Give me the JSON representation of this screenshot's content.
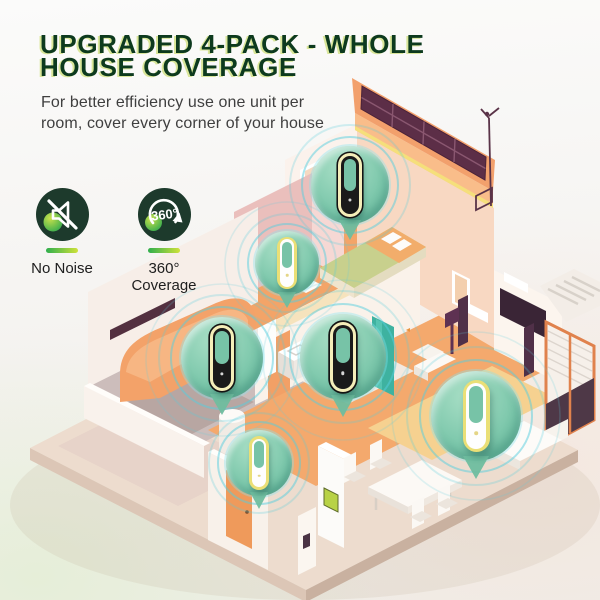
{
  "header": {
    "title_lines": [
      "UPGRADED 4-PACK - WHOLE",
      "HOUSE COVERAGE"
    ],
    "subtitle_lines": [
      "For better efficiency use one unit per",
      "room, cover every corner of your house"
    ]
  },
  "features": [
    {
      "id": "no-noise",
      "icon": "muted-speaker-icon",
      "label_lines": [
        "No Noise"
      ]
    },
    {
      "id": "360-coverage",
      "icon": "360-rotation-icon",
      "icon_text": "360°",
      "label_lines": [
        "360°",
        "Coverage"
      ]
    }
  ],
  "illustration": {
    "name": "isometric-house-cutaway",
    "rooms": [
      "bedroom",
      "hallway",
      "garage",
      "kitchen",
      "entry",
      "living-room"
    ],
    "devices": [
      {
        "room": "bedroom",
        "variant": "dark",
        "x": 350,
        "y": 185,
        "r": 39
      },
      {
        "room": "hallway",
        "variant": "light",
        "x": 287,
        "y": 263,
        "r": 32
      },
      {
        "room": "garage",
        "variant": "dark",
        "x": 222,
        "y": 358,
        "r": 41
      },
      {
        "room": "kitchen",
        "variant": "dark",
        "x": 343,
        "y": 357,
        "r": 43
      },
      {
        "room": "entry",
        "variant": "light",
        "x": 259,
        "y": 463,
        "r": 33
      },
      {
        "room": "living-room",
        "variant": "light",
        "x": 476,
        "y": 416,
        "r": 45
      }
    ]
  },
  "colors": {
    "title": "#0d3a1e",
    "subtitle": "#3f3f3f",
    "icon_bg": "#1d3a2c",
    "accent_a": "#2fae4d",
    "accent_b": "#cfe23a",
    "bubble": "#7cc7ab",
    "ripple": "#55cedd",
    "pointer": "#6fbd9f",
    "device_dark": "#1a1a1a",
    "device_light": "#fefefe",
    "ring_cream": "#f4eeb9",
    "ring_yellow": "#eadf76",
    "hole_teal": "#77c3a7",
    "roof_orange": "#f2a06c",
    "solar_panel": "#5c2e47"
  }
}
